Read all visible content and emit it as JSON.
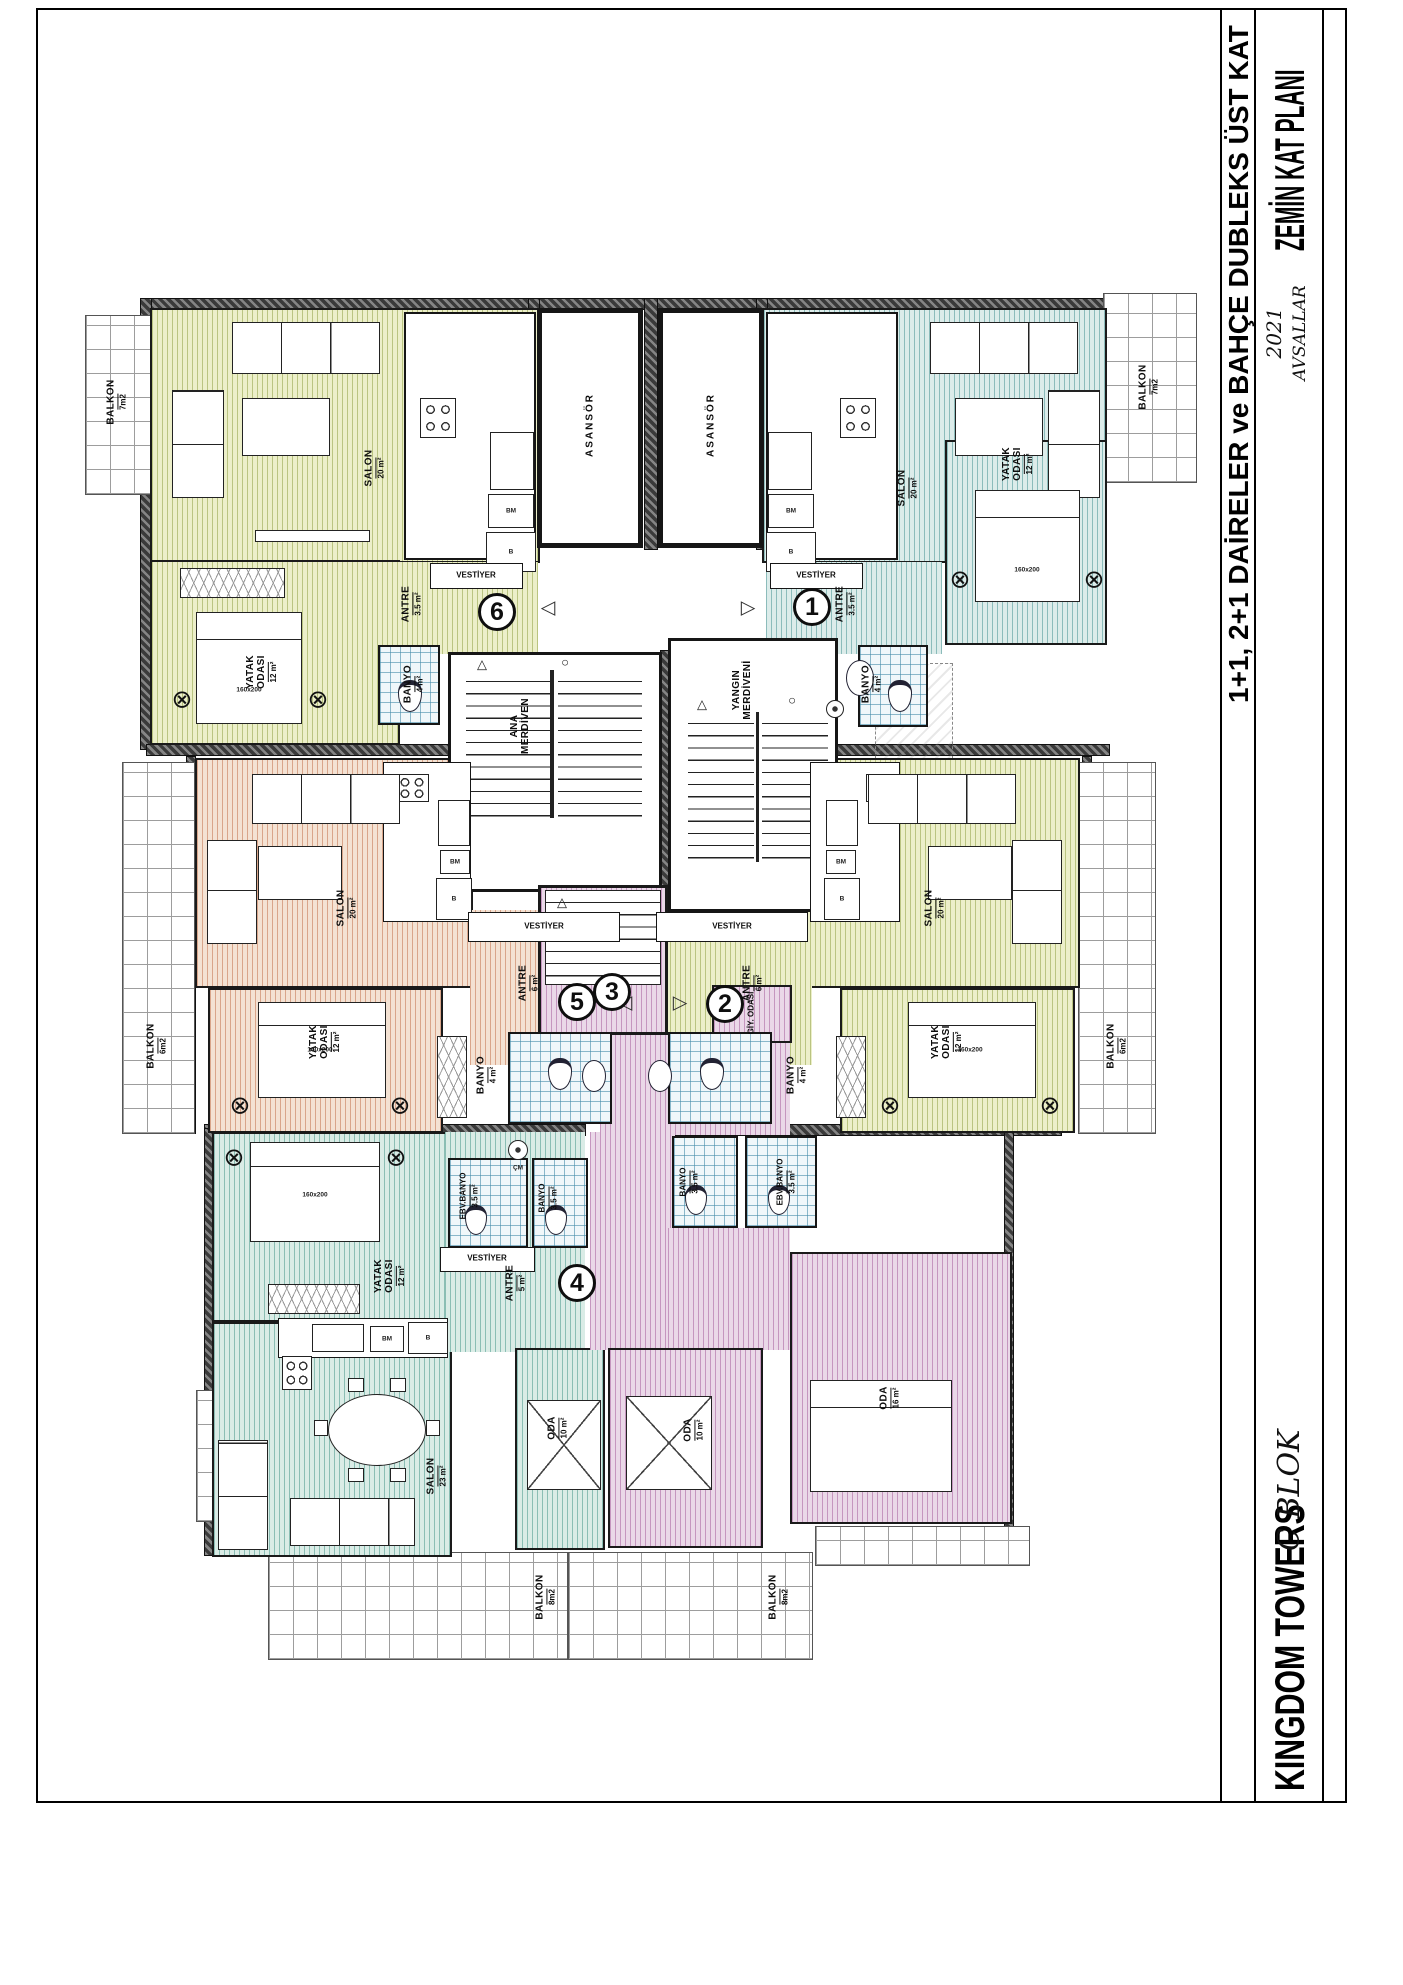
{
  "title_block": {
    "project": "KINGDOM TOWERS",
    "block": "C BLOK",
    "plan_title": "ZEMİN KAT PLANI",
    "subtitle": "1+1, 2+1 DAİRELER ve BAHÇE DUBLEKS ÜST KAT",
    "year": "2021",
    "location": "AVSALLAR"
  },
  "common": {
    "elevator": "ASANSÖR",
    "main_stair_line1": "ANA",
    "main_stair_line2": "MERDİVEN",
    "fire_stair_line1": "YANGIN",
    "fire_stair_line2": "MERDİVENİ",
    "vestibule": "VESTİYER",
    "bed_size": "160x200"
  },
  "appliances": {
    "fridge": "B",
    "dishwasher": "BM",
    "washer": "ÇM"
  },
  "icons": {
    "arrow_left": "◁",
    "arrow_right": "▷",
    "nightstand": "⊗",
    "stair_up": "△",
    "stair_node": "○"
  },
  "colors": {
    "apt1": "#dcecea",
    "apt2": "#ecefc9",
    "apt3": "#ead8e8",
    "apt4": "#daece6",
    "apt5": "#f4e2d3",
    "apt6": "#ecefc9",
    "bath_tile": "#f0f7fa",
    "wall": "#3a3a3a"
  },
  "apartments": {
    "a1": {
      "no": "1",
      "salon": "SALON",
      "salon_size": "20 m²",
      "bedroom": "YATAK ODASI",
      "bedroom_size": "12 m²",
      "antre": "ANTRE",
      "antre_size": "3.5 m²",
      "banyo": "BANYO",
      "banyo_size": "4 m²",
      "balkon": "BALKON",
      "balkon_size": "7m2"
    },
    "a2": {
      "no": "2",
      "salon": "SALON",
      "salon_size": "20 m²",
      "bedroom": "YATAK ODASI",
      "bedroom_size": "12 m²",
      "antre": "ANTRE",
      "antre_size": "6 m²",
      "banyo": "BANYO",
      "banyo_size": "4 m²",
      "balkon": "BALKON",
      "balkon_size": "6m2"
    },
    "a3": {
      "no": "3",
      "oda_small": "ODA",
      "oda_small_size": "10 m²",
      "oda_big": "ODA",
      "oda_big_size": "16 m²",
      "dressing": "GİY. ODASI",
      "banyo": "BANYO",
      "banyo_size": "3.5 m²",
      "ebv_banyo": "EBV.BANYO",
      "ebv_banyo_size": "3.5 m²",
      "balkon": "BALKON",
      "balkon_size": "8m2"
    },
    "a4": {
      "no": "4",
      "salon": "SALON",
      "salon_size": "23 m²",
      "bedroom": "YATAK ODASI",
      "bedroom_size": "12 m²",
      "oda": "ODA",
      "oda_size": "10 m²",
      "antre": "ANTRE",
      "antre_size": "5 m²",
      "ebv_banyo": "EBV.BANYO",
      "ebv_banyo_size": "3.5 m²",
      "banyo": "BANYO",
      "banyo_size": "3.5 m²",
      "balkon": "BALKON",
      "balkon_size": "8m2"
    },
    "a5": {
      "no": "5",
      "salon": "SALON",
      "salon_size": "20 m²",
      "bedroom": "YATAK ODASI",
      "bedroom_size": "12 m²",
      "antre": "ANTRE",
      "antre_size": "6 m²",
      "banyo": "BANYO",
      "banyo_size": "4 m²",
      "balkon": "BALKON",
      "balkon_size": "6m2"
    },
    "a6": {
      "no": "6",
      "salon": "SALON",
      "salon_size": "20 m²",
      "bedroom": "YATAK ODASI",
      "bedroom_size": "12 m²",
      "antre": "ANTRE",
      "antre_size": "3.5 m²",
      "banyo": "BANYO",
      "banyo_size": "4 m²",
      "balkon": "BALKON",
      "balkon_size": "7m2"
    }
  }
}
